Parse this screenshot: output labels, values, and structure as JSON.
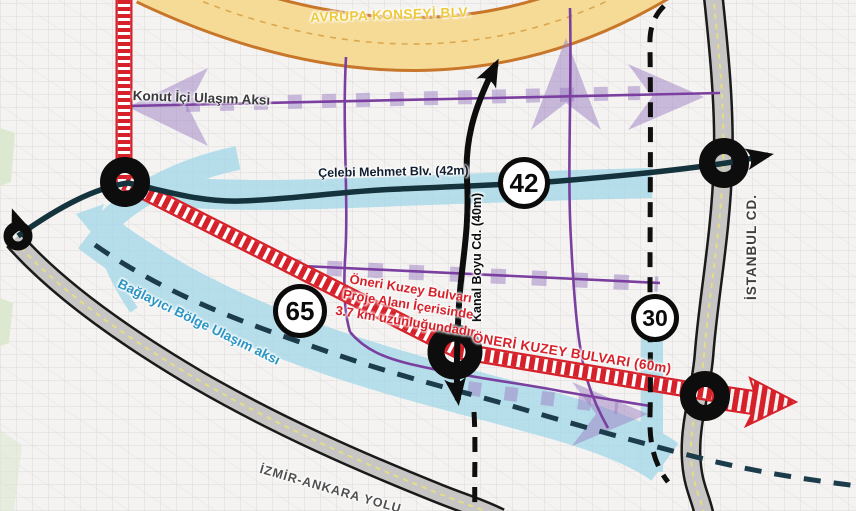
{
  "map": {
    "labels": {
      "avrupa_konseyi": "AVRUPA KONSEYİ BLV.",
      "konut_ici": "Konut İçi Ulaşım Aksı",
      "celebi_mehmet": "Çelebi Mehmet Blv. (42m)",
      "kanal_boyu": "Kanal Boyu Cd. (40m)",
      "oneri_kuzey_main": "ÖNERİ KUZEY BULVARI (60m)",
      "baglayici": "Bağlayıcı Bölge Ulaşım aksı",
      "istanbul": "İSTANBUL CD.",
      "izmir_ankara": "İZMİR-ANKARA YOLU"
    },
    "annotation": {
      "line1": "Öneri Kuzey Bulvarı",
      "line2": "Proje Alanı İçerisinde",
      "line3": "3.7 km uzunluğundadır"
    },
    "badges": {
      "b42": "42",
      "b65": "65",
      "b30": "30"
    },
    "colors": {
      "highway_yellow": "#f6db96",
      "highway_border": "#c8762a",
      "proposed_red": "#d6212a",
      "axis_purple": "#7a3f9f",
      "axis_purple_light": "#9b7fc4",
      "corridor_cyan": "#9ed7e8",
      "boulevard_teal": "#15333c",
      "connector_blue": "#2b96c4",
      "road_gray": "#c8c6c5",
      "road_centerline_yellow": "#e6e07c"
    }
  }
}
